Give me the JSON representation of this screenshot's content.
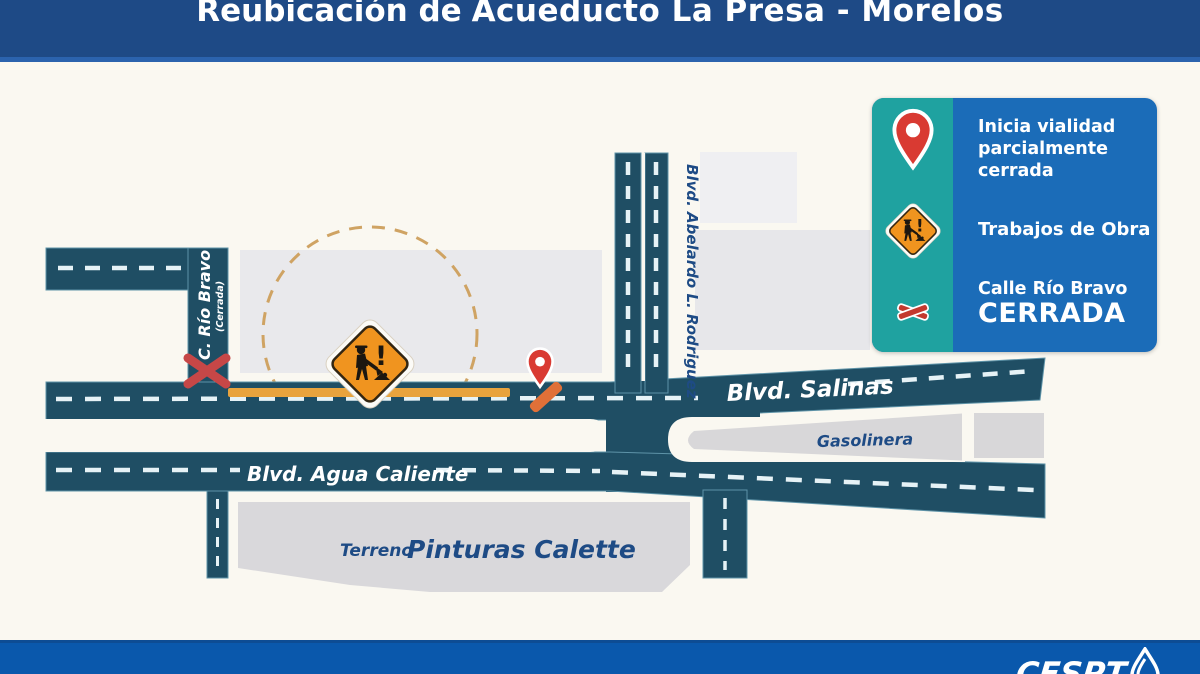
{
  "header": {
    "title_prefix": "Reubicación de",
    "title_main": "Acueducto La Presa - Morelos"
  },
  "legend": {
    "rows": [
      {
        "icon": "location-pin-icon",
        "lines": [
          "Inicia vialidad",
          "parcialmente",
          "cerrada"
        ]
      },
      {
        "icon": "roadwork-sign-icon",
        "label": "Trabajos de Obra"
      },
      {
        "icon": "road-closed-x-icon",
        "street": "Calle Río Bravo",
        "status": "CERRADA"
      }
    ]
  },
  "map": {
    "roads": {
      "salinas": "Blvd. Salinas",
      "agua_caliente": "Blvd. Agua Caliente",
      "abelardo": "Blvd. Abelardo L. Rodriguez",
      "rio_bravo": "C. Río Bravo",
      "rio_bravo_status": "(Cerrada)"
    },
    "areas": {
      "gasolinera": "Gasolinera",
      "terreno_prefix": "Terreno",
      "terreno_name": "Pinturas Calette"
    },
    "sign_exclamation": "!"
  },
  "footer": {
    "brand": "CESPT"
  },
  "colors": {
    "header_blue": "#1E4A86",
    "road_blue": "#1F4E64",
    "legend_teal": "#1FA2A0",
    "legend_blue": "#1B6CB8",
    "footer_blue": "#0A58AC",
    "construction_orange": "#E8A33D",
    "sign_orange": "#F0941F",
    "closure_red": "#D93A32",
    "ink_blue": "#1E4B85"
  }
}
